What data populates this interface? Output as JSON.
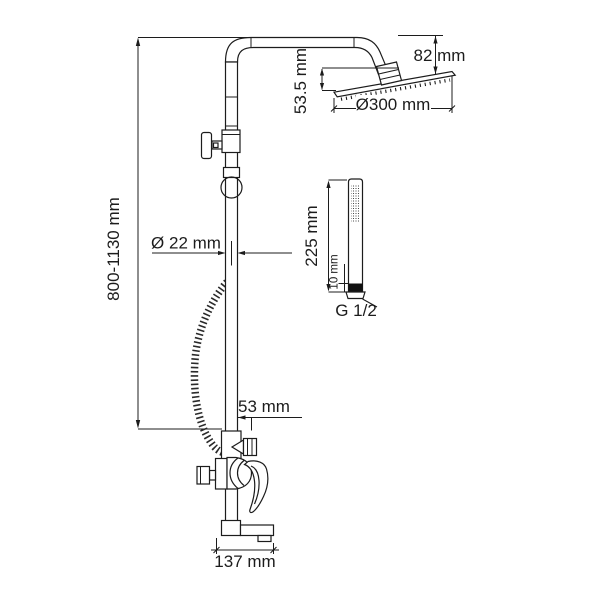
{
  "drawing": {
    "subject": "shower-column-technical-dimension-drawing",
    "background_color": "#ffffff",
    "line_color": "#1c1c1c",
    "views": {
      "main_view": "shower column with rain head arm, diverter, hose and bath mixer",
      "head_detail": "overhead rain shower plate, side view",
      "hand_shower_detail": "stick hand shower, side view"
    }
  },
  "dimensions": {
    "overall_height": "800-1130 mm",
    "head_arm_height": "82 mm",
    "head_drop": "53.5 mm",
    "head_diameter": "Ø300 mm",
    "column_diameter": "Ø 22 mm",
    "outlet_offset": "53 mm",
    "spout_reach": "137 mm",
    "hand_shower_length": "225 mm",
    "hand_shower_inlet": "10 mm",
    "connection_thread": "G 1/2"
  }
}
